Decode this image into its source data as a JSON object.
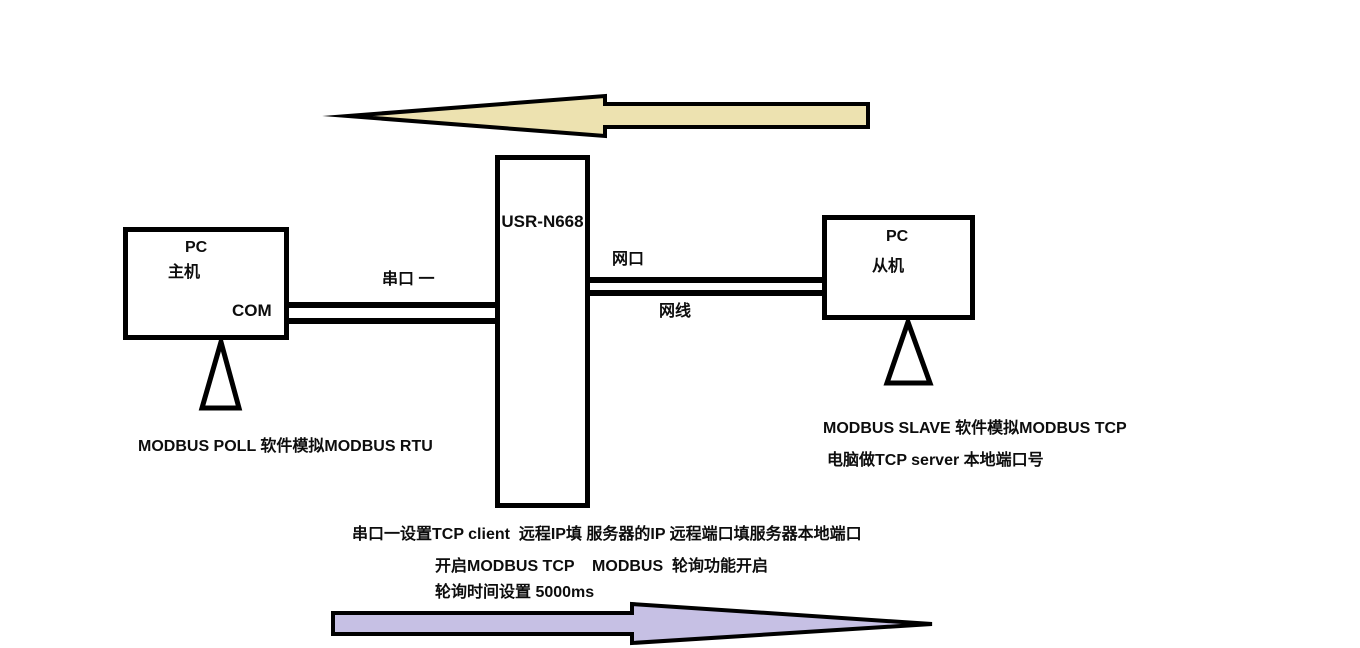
{
  "diagram": {
    "device": {
      "label": "USR-N668"
    },
    "left_pc": {
      "line1": "PC",
      "line2": "主机",
      "port_label": "COM"
    },
    "right_pc": {
      "line1": "PC",
      "line2": "从机"
    },
    "links": {
      "serial_label": "串口 一",
      "lan_port_label": "网口",
      "lan_cable_label": "网线"
    },
    "notes": {
      "left_note": "MODBUS POLL 软件模拟MODBUS RTU",
      "right_note_line1": "MODBUS SLAVE 软件模拟MODBUS TCP",
      "right_note_line2": "电脑做TCP server 本地端口号",
      "bottom_note_line1": "串口一设置TCP client  远程IP填 服务器的IP 远程端口填服务器本地端口",
      "bottom_note_line2": "开启MODBUS TCP    MODBUS  轮询功能开启",
      "bottom_note_line3": "轮询时间设置 5000ms"
    },
    "colors": {
      "top_arrow_fill": "#ede2b0",
      "bottom_arrow_fill": "#c6c0e4",
      "outline": "#000000"
    }
  }
}
